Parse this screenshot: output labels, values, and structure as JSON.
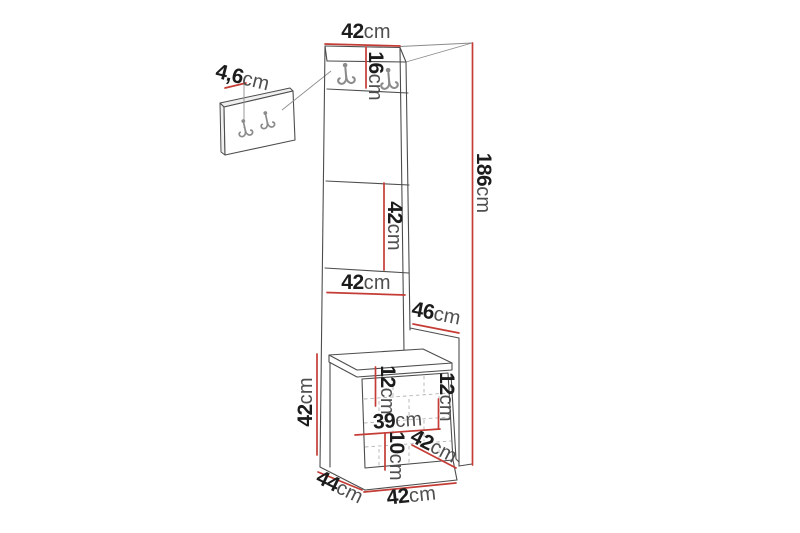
{
  "diagram": {
    "type": "furniture-dimension-diagram",
    "subject": "hallway coat-rack column with hook panels and quilted storage bench",
    "measurement_unit": "cm"
  },
  "colors": {
    "dimension_red": "#c43c35",
    "outline_gray": "#4d4d4d",
    "label_number": "#1c1c1c",
    "label_unit": "#4f4f4f",
    "background": "#ffffff"
  },
  "icons": {
    "hook": "double-wall-hook-icon"
  },
  "labels": {
    "top_width": {
      "num": "42",
      "unit": "cm"
    },
    "hook_panel_height": {
      "num": "16",
      "unit": "cm"
    },
    "wall_panel_depth": {
      "num": "4,6",
      "unit": "cm"
    },
    "upper_panel_height": {
      "num": "42",
      "unit": "cm"
    },
    "panel_width": {
      "num": "42",
      "unit": "cm"
    },
    "side_depth": {
      "num": "46",
      "unit": "cm"
    },
    "total_height": {
      "num": "186",
      "unit": "cm"
    },
    "bench_height": {
      "num": "42",
      "unit": "cm"
    },
    "seat_inset": {
      "num": "12",
      "unit": "cm"
    },
    "compartment_height": {
      "num": "12",
      "unit": "cm"
    },
    "inner_width": {
      "num": "39",
      "unit": "cm"
    },
    "plinth_height": {
      "num": "10",
      "unit": "cm"
    },
    "seat_depth": {
      "num": "42",
      "unit": "cm"
    },
    "base_depth": {
      "num": "44",
      "unit": "cm"
    },
    "bench_width": {
      "num": "42",
      "unit": "cm"
    }
  }
}
